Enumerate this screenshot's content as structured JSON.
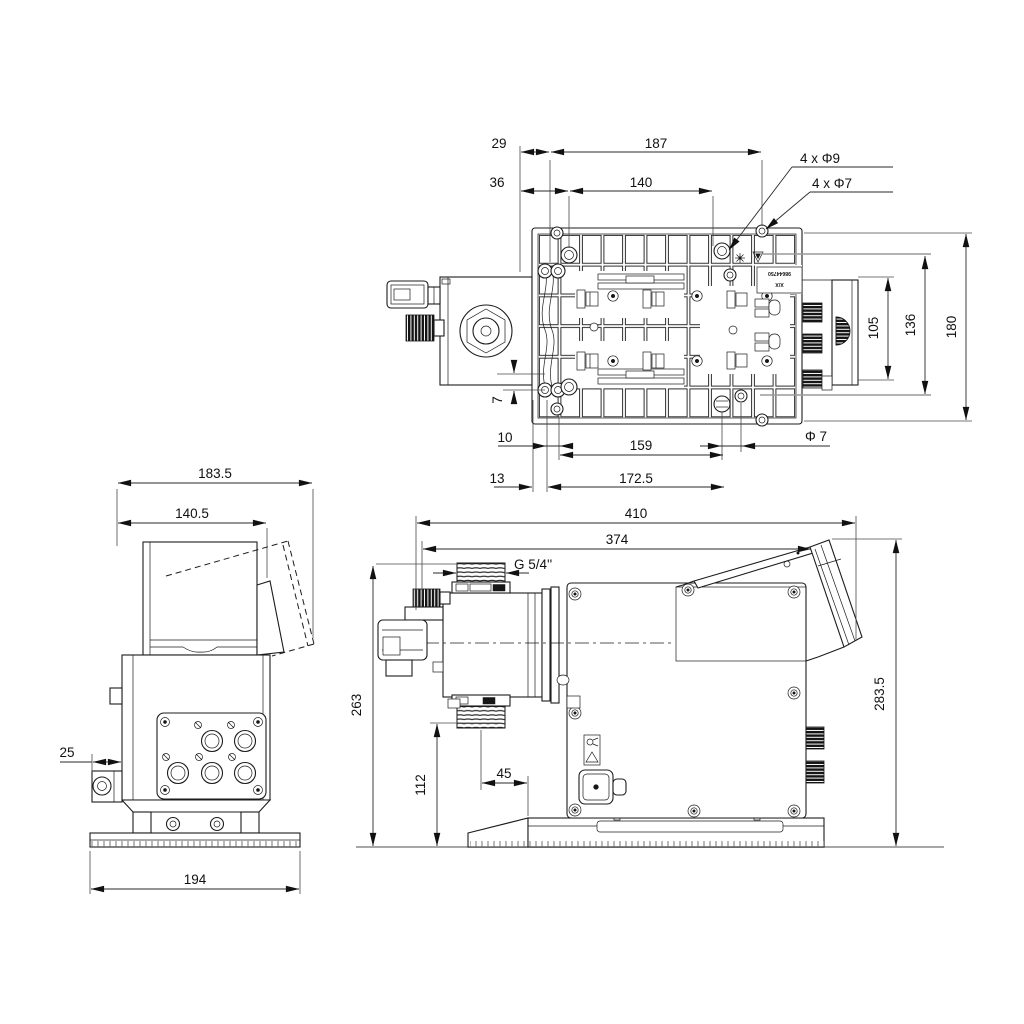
{
  "top_view": {
    "d29": "29",
    "d187": "187",
    "d36": "36",
    "d140": "140",
    "holes9": "4 x Φ9",
    "holes7": "4 x Φ7",
    "d105": "105",
    "d136": "136",
    "d180": "180",
    "d7": "7",
    "d10": "10",
    "d159": "159",
    "dia7": "Φ 7",
    "d13": "13",
    "d172_5": "172.5"
  },
  "left_view": {
    "d183_5": "183.5",
    "d140_5": "140.5",
    "d25": "25",
    "d194": "194"
  },
  "front_view": {
    "d410": "410",
    "d374": "374",
    "thread": "G 5/4''",
    "d263": "263",
    "d112": "112",
    "d45": "45",
    "d283_5": "283.5"
  },
  "plate_label": {
    "line1": "X/X",
    "line2": "98644750"
  },
  "icons": {
    "snowflake": "snowflake-icon",
    "warning": "warning-triangle-icon"
  }
}
